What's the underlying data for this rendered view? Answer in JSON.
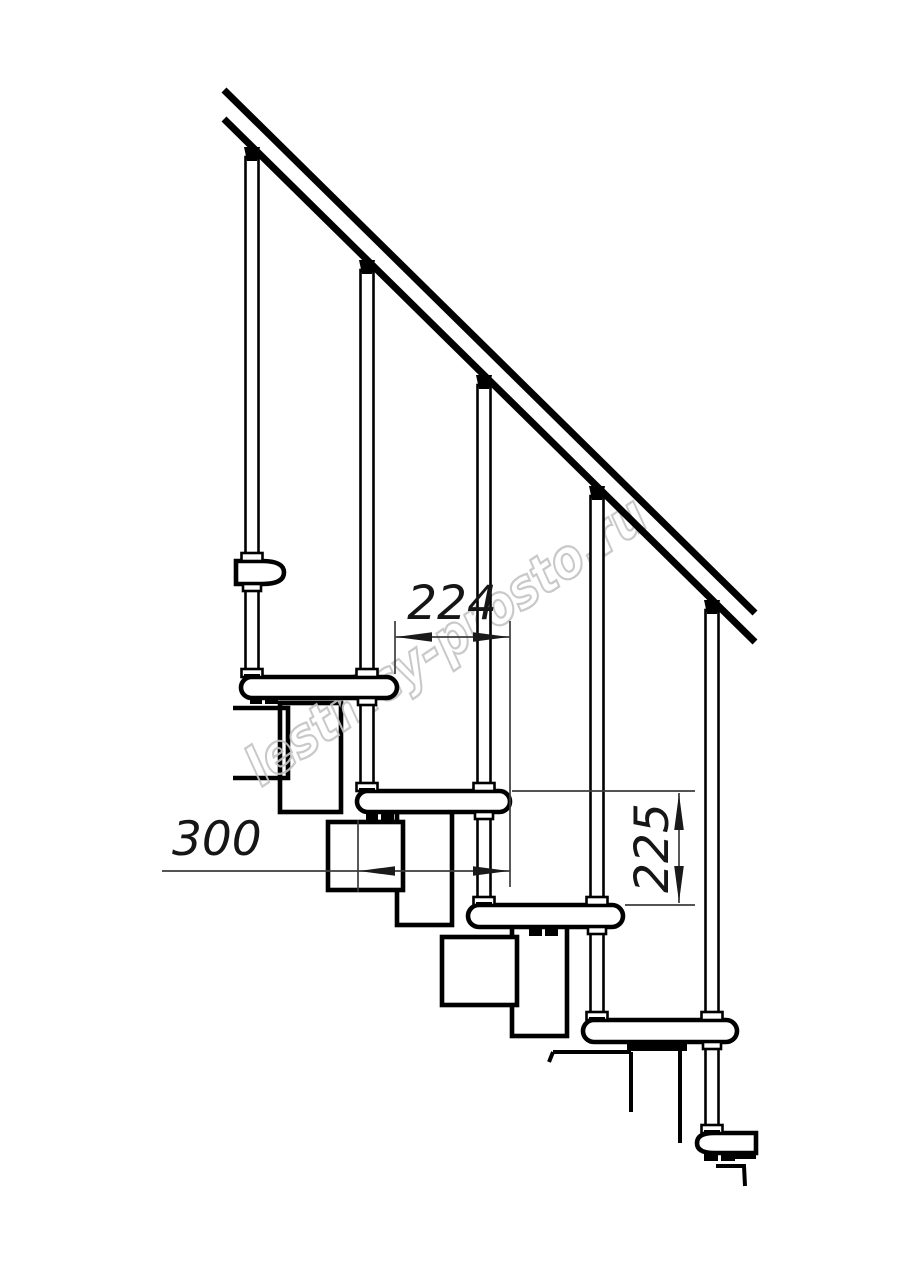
{
  "drawing": {
    "watermark_text": "lestnicy-prosto.ru",
    "dimensions": {
      "tread_depth": "300",
      "step_going": "224",
      "riser_height": "225"
    },
    "colors": {
      "line": "#000000",
      "dimension_line": "#3c3c3c",
      "watermark": "#c4c4c4",
      "background": "#ffffff"
    }
  }
}
